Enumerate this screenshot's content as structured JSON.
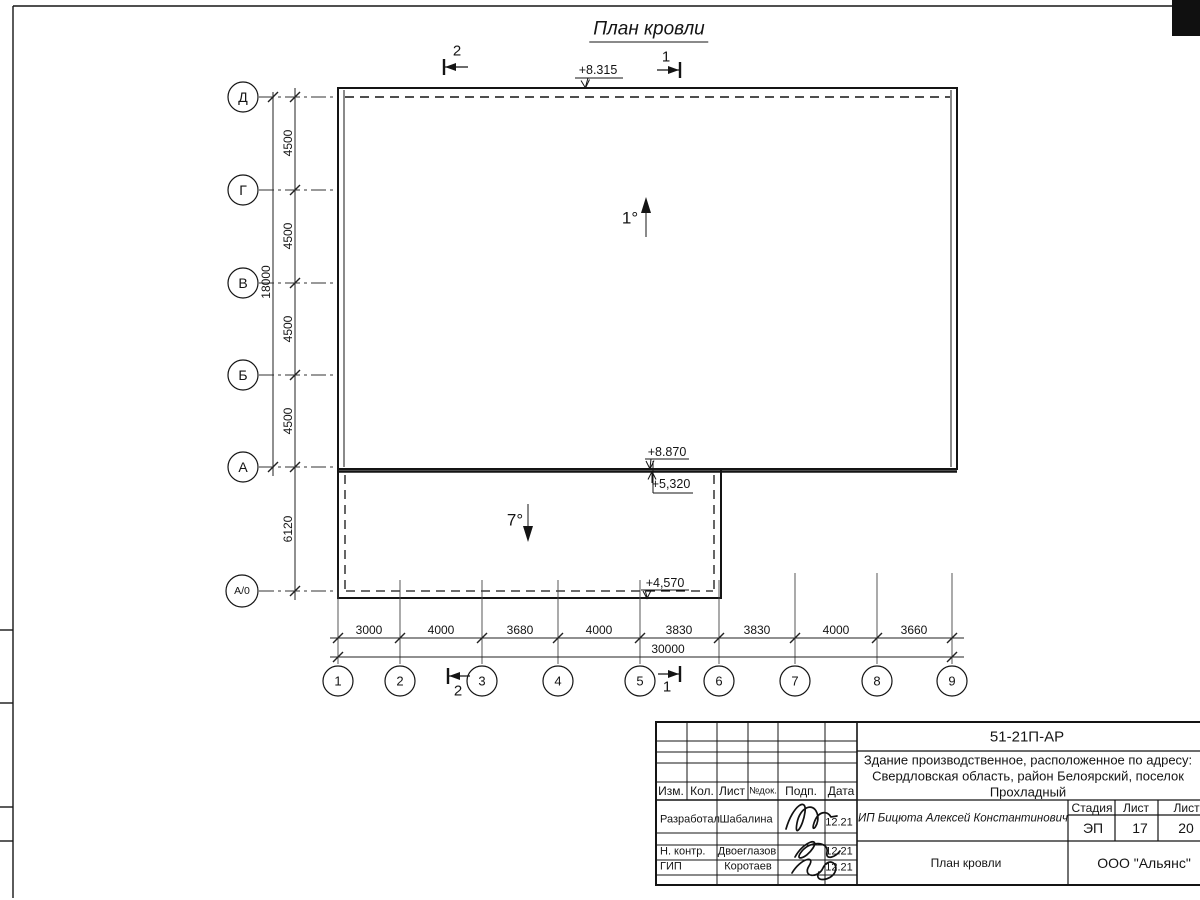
{
  "sheet": {
    "title": "План кровли"
  },
  "plan": {
    "slope_main": "1°",
    "slope_annex": "7°",
    "elev_top": "+8.315",
    "elev_wall_top": "+8.870",
    "elev_annex_roof": "+5,320",
    "elev_annex_edge": "+4,570",
    "section_1": "1",
    "section_2": "2"
  },
  "axes": {
    "rows": [
      "Д",
      "Г",
      "В",
      "Б",
      "А",
      "А/0"
    ],
    "cols": [
      "1",
      "2",
      "3",
      "4",
      "5",
      "6",
      "7",
      "8",
      "9"
    ]
  },
  "dims": {
    "left": [
      "4500",
      "4500",
      "4500",
      "4500"
    ],
    "left_annex": "6120",
    "left_total": "18000",
    "bottom": [
      "3000",
      "4000",
      "3680",
      "4000",
      "3830",
      "3830",
      "4000",
      "3660"
    ],
    "bottom_total": "30000"
  },
  "title_block": {
    "doc_number": "51-21П-АР",
    "project_line1": "Здание производственное, расположенное по адресу:",
    "project_line2": "Свердловская область, район Белоярский, поселок",
    "project_line3": "Прохладный",
    "col_headers": [
      "Изм.",
      "Кол.",
      "Лист",
      "№док.",
      "Подп.",
      "Дата"
    ],
    "rows": [
      {
        "role": "Разработал",
        "name": "Шабалина",
        "date": "12.21"
      },
      {
        "role": "Н. контр.",
        "name": "Двоеглазов",
        "date": "12.21"
      },
      {
        "role": "ГИП",
        "name": "Коротаев",
        "date": "12.21"
      }
    ],
    "client": "ИП Бицюта Алексей Константинович",
    "stage_header": "Стадия",
    "sheet_header": "Лист",
    "sheets_header": "Листов",
    "stage": "ЭП",
    "sheet_num": "17",
    "sheets_total": "20",
    "doc_title": "План кровли",
    "company": "ООО \"Альянс\""
  }
}
